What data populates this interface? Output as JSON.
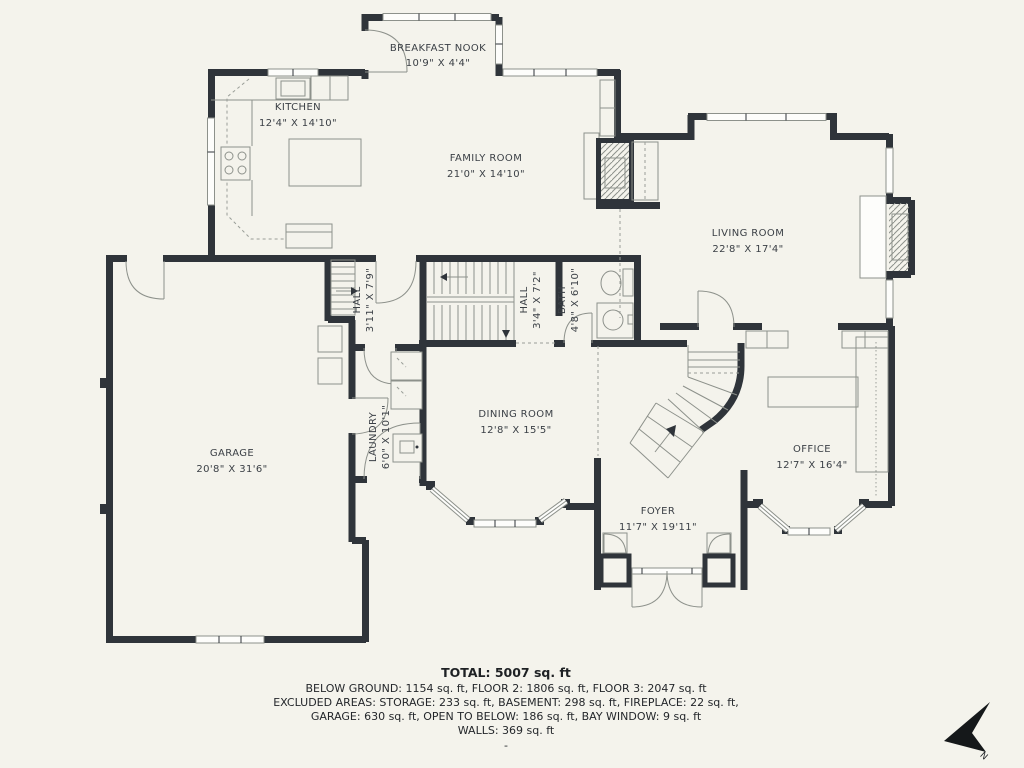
{
  "plan": {
    "rooms": {
      "breakfast_nook": {
        "name": "BREAKFAST NOOK",
        "dims": "10'9\" X 4'4\""
      },
      "kitchen": {
        "name": "KITCHEN",
        "dims": "12'4\" X 14'10\""
      },
      "family_room": {
        "name": "FAMILY ROOM",
        "dims": "21'0\" X 14'10\""
      },
      "living_room": {
        "name": "LIVING ROOM",
        "dims": "22'8\" X 17'4\""
      },
      "hall_upper": {
        "name": "HALL",
        "dims": "3'11\" X 7'9\""
      },
      "hall_center": {
        "name": "HALL",
        "dims": "3'4\" X 7'2\""
      },
      "bath": {
        "name": "BATH",
        "dims": "4'8\" X 6'10\""
      },
      "garage": {
        "name": "GARAGE",
        "dims": "20'8\" X 31'6\""
      },
      "laundry": {
        "name": "LAUNDRY",
        "dims": "6'0\" X 10'1\""
      },
      "dining_room": {
        "name": "DINING ROOM",
        "dims": "12'8\" X 15'5\""
      },
      "foyer": {
        "name": "FOYER",
        "dims": "11'7\" X 19'11\""
      },
      "office": {
        "name": "OFFICE",
        "dims": "12'7\" X 16'4\""
      }
    },
    "summary": {
      "total": "TOTAL: 5007 sq. ft",
      "line1": "BELOW GROUND: 1154 sq. ft, FLOOR 2: 1806 sq. ft, FLOOR 3: 2047 sq. ft",
      "line2": "EXCLUDED AREAS: STORAGE: 233 sq. ft, BASEMENT: 298 sq. ft, FIREPLACE: 22 sq. ft,",
      "line3": "GARAGE: 630 sq. ft, OPEN TO BELOW: 186 sq. ft, BAY WINDOW: 9 sq. ft",
      "line4": "WALLS: 369 sq. ft",
      "dash": "-"
    },
    "compass": {
      "north_label": "N"
    },
    "colors": {
      "background": "#F4F3EC",
      "wall": "#2F343A",
      "line": "#8D918B",
      "text": "#3A3F45"
    }
  }
}
